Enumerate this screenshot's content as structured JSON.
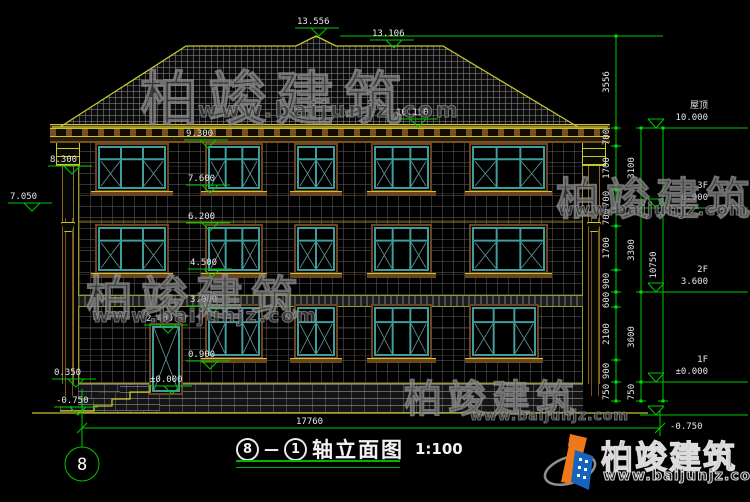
{
  "drawing_title": {
    "axis_start": "8",
    "dash": "—",
    "axis_end": "1",
    "name": "轴立面图",
    "scale": "1:100"
  },
  "axis_bubble": {
    "label": "8"
  },
  "watermark": {
    "brand": "柏竣建筑",
    "url": "www.baijunjz.com"
  },
  "logo": {
    "brand": "柏竣建筑",
    "url": "www.baijunjz.com"
  },
  "colors": {
    "dim_green": "#00c800",
    "line_yellow": "#c6c62e",
    "window_teal": "#3f9d9d",
    "trim_brown": "#7c4f1e",
    "label_white": "#e8e8e8",
    "logo_orange": "#f07818",
    "logo_blue": "#1565c0"
  },
  "elevation_markers": [
    {
      "label": "13.556",
      "x": 297,
      "y": 17
    },
    {
      "label": "13.106",
      "x": 372,
      "y": 29
    },
    {
      "label": "10.150",
      "x": 396,
      "y": 108
    },
    {
      "label": "9.300",
      "x": 186,
      "y": 129
    },
    {
      "label": "8.300",
      "x": 50,
      "y": 155
    },
    {
      "label": "7.600",
      "x": 188,
      "y": 174
    },
    {
      "label": "7.050",
      "x": 10,
      "y": 192
    },
    {
      "label": "6.200",
      "x": 188,
      "y": 212
    },
    {
      "label": "4.500",
      "x": 190,
      "y": 258
    },
    {
      "label": "3.000",
      "x": 190,
      "y": 295
    },
    {
      "label": "2.400",
      "x": 146,
      "y": 314
    },
    {
      "label": "0.900",
      "x": 188,
      "y": 350
    },
    {
      "label": "±0.000",
      "x": 150,
      "y": 375
    },
    {
      "label": "0.350",
      "x": 54,
      "y": 368
    },
    {
      "label": "-0.750",
      "x": 56,
      "y": 396
    }
  ],
  "floor_markers": [
    {
      "name": "屋顶",
      "elev": "10.000",
      "y": 128
    },
    {
      "name": "3F",
      "elev": "6.900",
      "y": 208
    },
    {
      "name": "2F",
      "elev": "3.600",
      "y": 292
    },
    {
      "name": "1F",
      "elev": "±0.000",
      "y": 382
    },
    {
      "name": "",
      "elev": "-0.750",
      "y": 415
    }
  ],
  "dim_chains": [
    {
      "x": 616,
      "b": [
        36,
        128,
        146,
        190,
        208,
        226,
        270,
        292,
        307,
        360,
        382,
        401
      ],
      "values": [
        "3556",
        "700",
        "1700",
        "700",
        "700",
        "1700",
        "900",
        "600",
        "2100",
        "900",
        "750"
      ]
    },
    {
      "x": 641,
      "b": [
        128,
        208,
        292,
        382,
        401
      ],
      "values": [
        "3100",
        "3300",
        "3600",
        "750"
      ]
    },
    {
      "x": 663,
      "b": [
        128,
        401
      ],
      "values": [
        "10750"
      ]
    }
  ],
  "bottom_dim": {
    "value": "17760"
  },
  "windows": {
    "rows": [
      {
        "y": 143,
        "h": 49,
        "items": [
          {
            "x": 95,
            "w": 74,
            "cols": 3
          },
          {
            "x": 205,
            "w": 58,
            "cols": 3
          },
          {
            "x": 294,
            "w": 44,
            "cols": 2
          },
          {
            "x": 371,
            "w": 61,
            "cols": 3
          },
          {
            "x": 469,
            "w": 79,
            "cols": 3
          }
        ]
      },
      {
        "y": 224,
        "h": 50,
        "items": [
          {
            "x": 95,
            "w": 74,
            "cols": 3
          },
          {
            "x": 205,
            "w": 58,
            "cols": 3
          },
          {
            "x": 294,
            "w": 44,
            "cols": 2
          },
          {
            "x": 371,
            "w": 61,
            "cols": 3
          },
          {
            "x": 469,
            "w": 79,
            "cols": 3
          }
        ]
      },
      {
        "y": 304,
        "h": 55,
        "items": [
          {
            "x": 205,
            "w": 58,
            "cols": 3
          },
          {
            "x": 294,
            "w": 44,
            "cols": 2
          },
          {
            "x": 371,
            "w": 61,
            "cols": 3
          },
          {
            "x": 469,
            "w": 70,
            "cols": 3
          }
        ]
      }
    ]
  },
  "door": {
    "x": 149,
    "y": 323,
    "w": 34,
    "h": 72
  }
}
